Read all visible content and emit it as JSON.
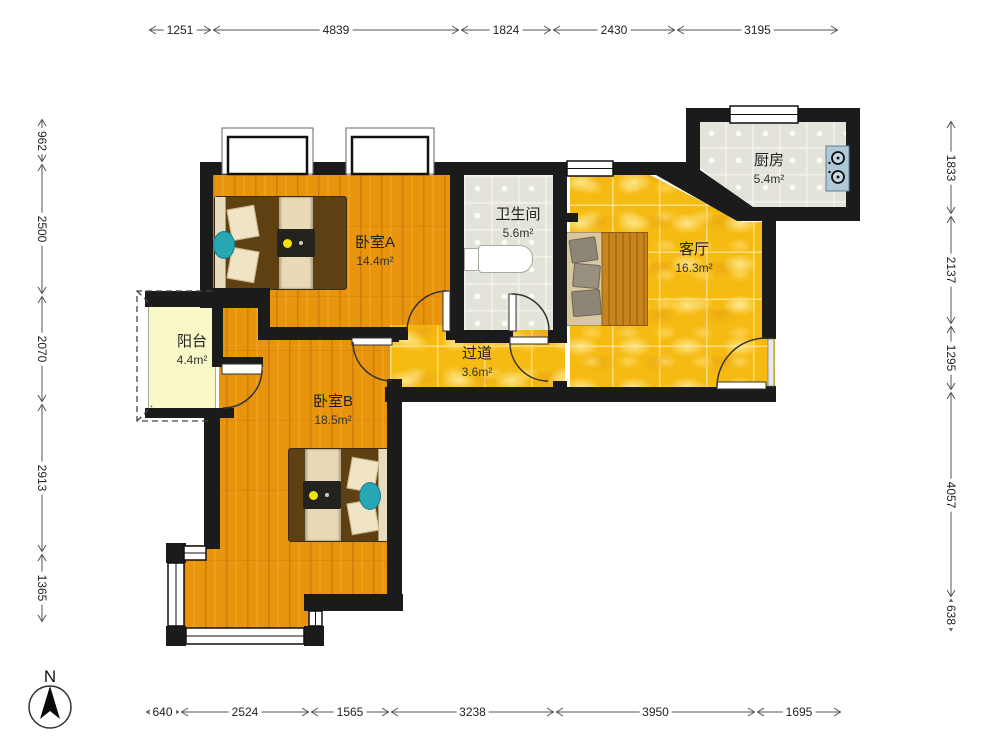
{
  "rooms": [
    {
      "id": "bedroom-a",
      "name": "卧室A",
      "area": "14.4m²"
    },
    {
      "id": "bathroom",
      "name": "卫生间",
      "area": "5.6m²"
    },
    {
      "id": "kitchen",
      "name": "厨房",
      "area": "5.4m²"
    },
    {
      "id": "living-room",
      "name": "客厅",
      "area": "16.3m²"
    },
    {
      "id": "balcony",
      "name": "阳台",
      "area": "4.4m²"
    },
    {
      "id": "hallway",
      "name": "过道",
      "area": "3.6m²"
    },
    {
      "id": "bedroom-b",
      "name": "卧室B",
      "area": "18.5m²"
    }
  ],
  "dimensions_mm": {
    "top": [
      "1251",
      "4839",
      "1824",
      "2430",
      "3195"
    ],
    "left": [
      "962",
      "2500",
      "2070",
      "2913",
      "1365"
    ],
    "right": [
      "1833",
      "2137",
      "1295",
      "4057",
      "638"
    ],
    "bottom": [
      "640",
      "2524",
      "1565",
      "3238",
      "3950",
      "1695"
    ]
  },
  "compass": {
    "label": "N"
  },
  "colors": {
    "wall": "#1B1B1B",
    "wood_floor": "#E8940D",
    "marble_floor": "#F6BB12",
    "tile_floor": "#E4E3D9",
    "balcony_floor": "#F8F9C6",
    "accent_teal": "#27A6B4",
    "lamp_yellow": "#F0E40A",
    "stove_blue": "#AFC9D6"
  }
}
